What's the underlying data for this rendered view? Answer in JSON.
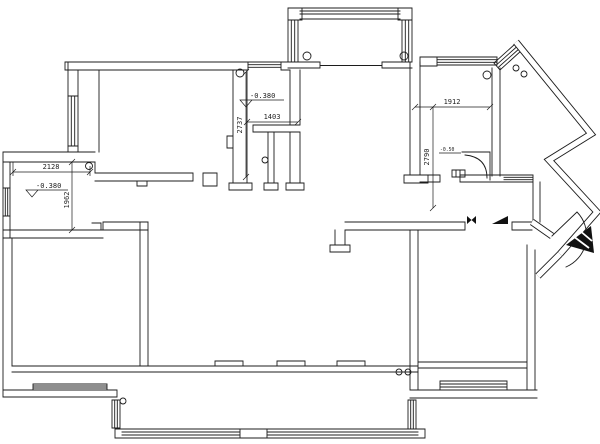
{
  "drawing": {
    "type": "residential floor plan (CAD line drawing)",
    "background": "#ffffff",
    "line_color": "#1c1c1c",
    "dims": {
      "annex_width": "2128",
      "annex_depth": "1962",
      "mid_room_width": "1403",
      "mid_room_depth": "2737",
      "bath_width": "1912",
      "bath_depth": "2790"
    },
    "levels": {
      "annex_level": "-0.380",
      "mid_room_level": "-0.380",
      "entry_step_level": "-0.50"
    }
  }
}
